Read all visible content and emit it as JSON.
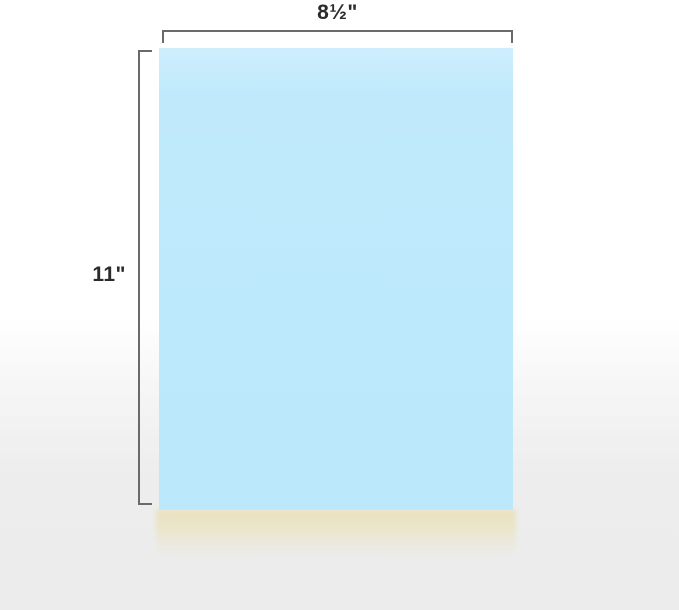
{
  "diagram": {
    "subject": "sheet-of-paper-dimensions",
    "width_label": "8½\"",
    "height_label": "11\"",
    "colors": {
      "paper_blue": "#bde9fc",
      "paper_blue_top": "#cfeefd",
      "ream_cream": "#e9e1bd",
      "dimension_line": "#6a6a6a",
      "label_text": "#2b2b2b",
      "background_top": "#ffffff",
      "background_bottom": "#ececec"
    }
  }
}
